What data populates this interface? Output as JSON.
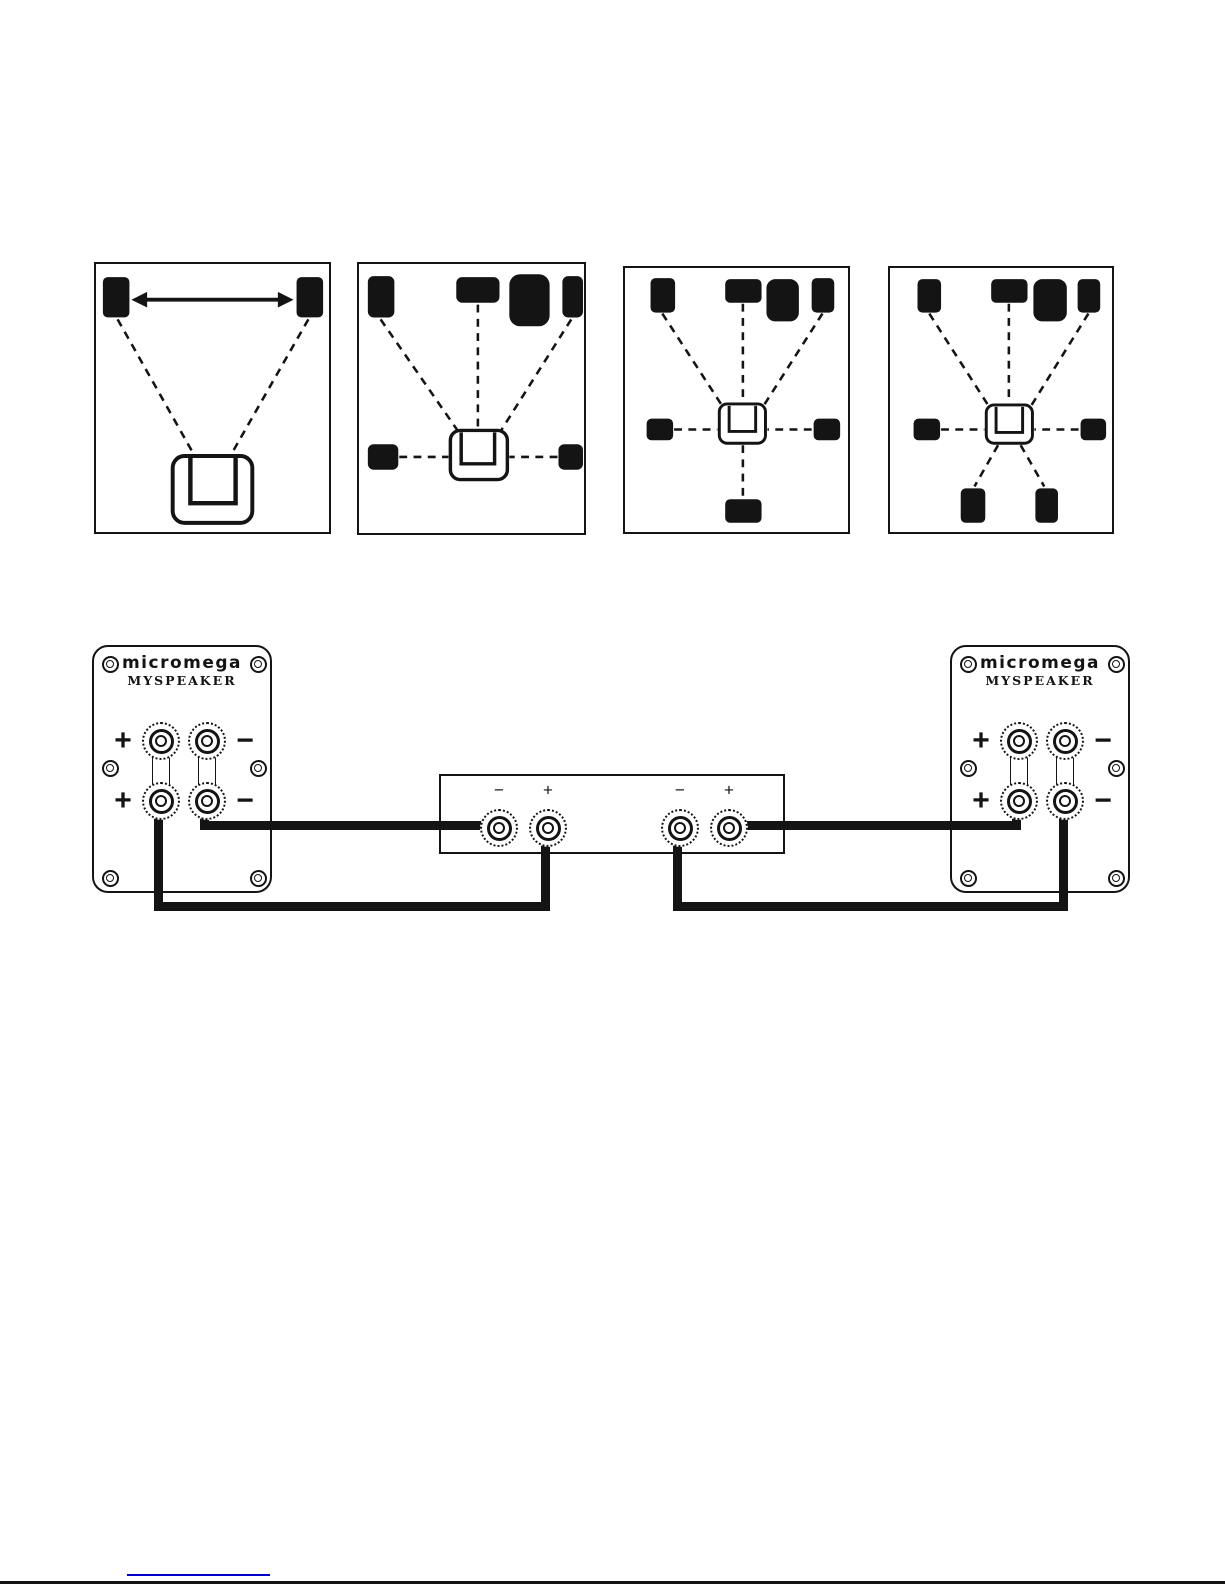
{
  "document": {
    "kind": "speaker-manual-diagram-page",
    "paper_color": "#ffffff",
    "ink_color": "#141414"
  },
  "placement_diagrams": [
    {
      "id": "stereo-2-0",
      "icons": [
        "front-left-speaker",
        "front-right-speaker",
        "equidistance-arrow",
        "listening-position"
      ]
    },
    {
      "id": "surround-5-1",
      "icons": [
        "front-left-speaker",
        "center-speaker",
        "subwoofer",
        "front-right-speaker",
        "side-left-speaker",
        "side-right-speaker",
        "listening-position"
      ]
    },
    {
      "id": "surround-6-1",
      "icons": [
        "front-left-speaker",
        "center-speaker",
        "subwoofer",
        "front-right-speaker",
        "side-left-speaker",
        "side-right-speaker",
        "rear-center-speaker",
        "listening-position"
      ]
    },
    {
      "id": "surround-7-1",
      "icons": [
        "front-left-speaker",
        "center-speaker",
        "subwoofer",
        "front-right-speaker",
        "side-left-speaker",
        "side-right-speaker",
        "rear-left-speaker",
        "rear-right-speaker",
        "listening-position"
      ]
    }
  ],
  "wiring": {
    "speaker_plate_left": {
      "brand": "MICROMEGA",
      "model": "MYSPEAKER",
      "terminal_plus": "+",
      "terminal_minus": "−"
    },
    "speaker_plate_right": {
      "brand": "MICROMEGA",
      "model": "MYSPEAKER",
      "terminal_plus": "+",
      "terminal_minus": "−"
    },
    "amplifier": {
      "terminal_labels": [
        "−",
        "+",
        "−",
        "+"
      ]
    }
  },
  "footer": {
    "link_underline_color": "#0000cc",
    "bottom_rule_color": "#141414"
  }
}
